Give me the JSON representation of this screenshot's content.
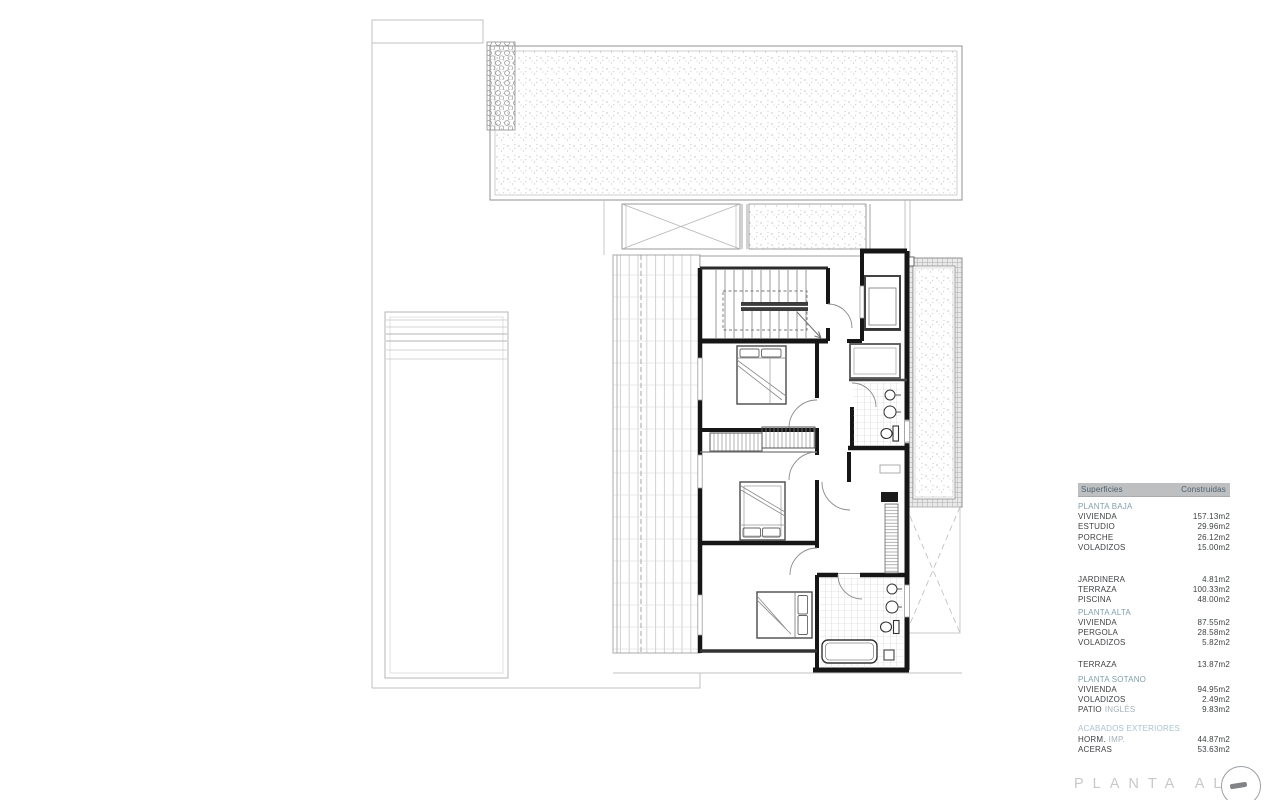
{
  "table": {
    "header": {
      "col1": "Superficies",
      "col2": "Construidas"
    },
    "groups": [
      {
        "title": "PLANTA BAJA",
        "rows": [
          {
            "label": "VIVIENDA",
            "value": "157.13m2"
          },
          {
            "label": "ESTUDIO",
            "value": "29.96m2"
          },
          {
            "label": "PORCHE",
            "value": "26.12m2"
          },
          {
            "label": "VOLADIZOS",
            "value": "15.00m2"
          }
        ]
      },
      {
        "title": "",
        "rows": [
          {
            "label": "JARDINERA",
            "value": "4.81m2"
          },
          {
            "label": "TERRAZA",
            "value": "100.33m2"
          },
          {
            "label": "PISCINA",
            "value": "48.00m2"
          }
        ]
      },
      {
        "title": "PLANTA ALTA",
        "rows": [
          {
            "label": "VIVIENDA",
            "value": "87.55m2"
          },
          {
            "label": "PERGOLA",
            "value": "28.58m2"
          },
          {
            "label": "VOLADIZOS",
            "value": "5.82m2"
          }
        ]
      },
      {
        "title": "",
        "rows": [
          {
            "label": "TERRAZA",
            "value": "13.87m2"
          }
        ]
      },
      {
        "title": "PLANTA SOTANO",
        "rows": [
          {
            "label": "VIVIENDA",
            "value": "94.95m2"
          },
          {
            "label": "VOLADIZOS",
            "value": "2.49m2"
          },
          {
            "label": "PATIO",
            "suffix": "INGLÉS",
            "value": "9.83m2"
          }
        ]
      },
      {
        "title": "ACABADOS EXTERIORES",
        "rows": [
          {
            "label": "HORM.",
            "suffix": "IMP.",
            "value": "44.87m2"
          },
          {
            "label": "ACERAS",
            "value": "53.63m2"
          }
        ]
      }
    ]
  },
  "footer": {
    "plan_title": "PLANTA ALTA",
    "logo_icon": "logo-circle-mark"
  },
  "colors": {
    "accent_teal": "#7f9fae",
    "header_gray": "#bdbfc1",
    "ink": "#161616",
    "light_line": "#8f8f8f",
    "watermark": "#c6c8ca"
  }
}
